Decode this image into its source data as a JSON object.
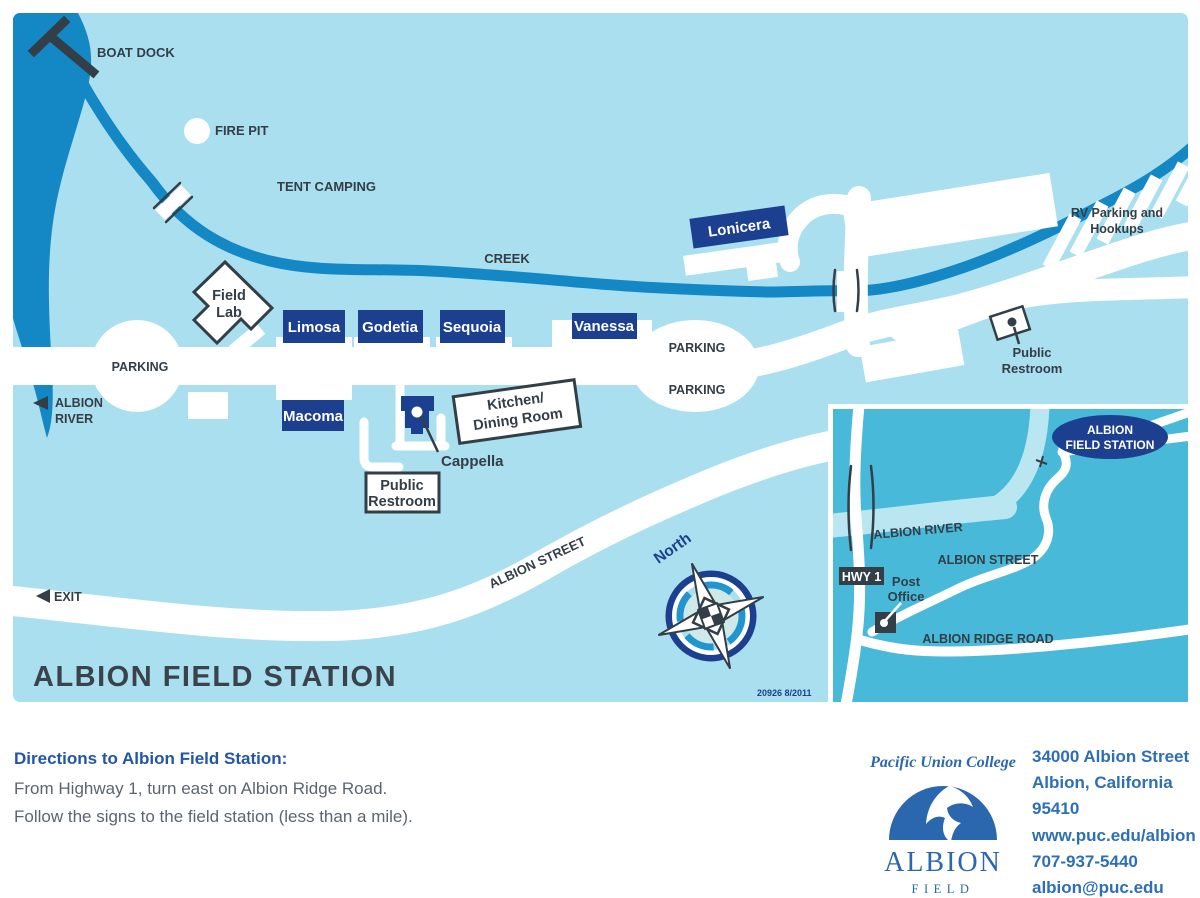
{
  "map": {
    "title": "ALBION FIELD STATION",
    "code": "20926 8/2011",
    "labels": {
      "boat_dock": "BOAT DOCK",
      "fire_pit": "FIRE PIT",
      "tent_camping": "TENT CAMPING",
      "creek": "CREEK",
      "parking": "PARKING",
      "albion_river_line1": "ALBION",
      "albion_river_line2": "RIVER",
      "exit": "EXIT",
      "albion_street": "ALBION STREET",
      "north": "North",
      "rv_parking_line1": "RV Parking and",
      "rv_parking_line2": "Hookups",
      "public_restroom_line1": "Public",
      "public_restroom_line2": "Restroom",
      "kitchen_line1": "Kitchen/",
      "kitchen_line2": "Dining Room",
      "field_lab_line1": "Field",
      "field_lab_line2": "Lab",
      "cappella": "Cappella"
    },
    "buildings": {
      "limosa": "Limosa",
      "godetia": "Godetia",
      "sequoia": "Sequoia",
      "vanessa": "Vanessa",
      "lonicera": "Lonicera",
      "macoma": "Macoma"
    }
  },
  "inset": {
    "station_line1": "ALBION",
    "station_line2": "FIELD STATION",
    "hwy1": "HWY 1",
    "post_office_line1": "Post",
    "post_office_line2": "Office",
    "albion_river": "ALBION RIVER",
    "albion_street": "ALBION STREET",
    "albion_ridge_road": "ALBION RIDGE ROAD"
  },
  "footer": {
    "directions_heading": "Directions to Albion Field Station:",
    "directions_line1": "From Highway 1, turn east on Albion Ridge Road.",
    "directions_line2": "Follow the signs to the field station (less than a mile).",
    "logo": {
      "college": "Pacific Union College",
      "name": "ALBION",
      "subname": "FIELD STATION"
    },
    "contact": {
      "address_line1": "34000 Albion Street",
      "address_line2": "Albion, California",
      "address_line3": "95410",
      "website": "www.puc.edu/albion",
      "phone": "707-937-5440",
      "email": "albion@puc.edu"
    }
  },
  "colors": {
    "map_background": "#a9dfee",
    "water_blue": "#1487c5",
    "building_navy": "#1d3f8f",
    "label_charcoal": "#333e47",
    "inset_background": "#49b9da",
    "inset_river": "#b9e6f1",
    "logo_blue": "#2b67ae",
    "footer_heading_blue": "#2356a6",
    "footer_text_gray": "#5b6570",
    "contact_blue": "#2d6fb7"
  }
}
